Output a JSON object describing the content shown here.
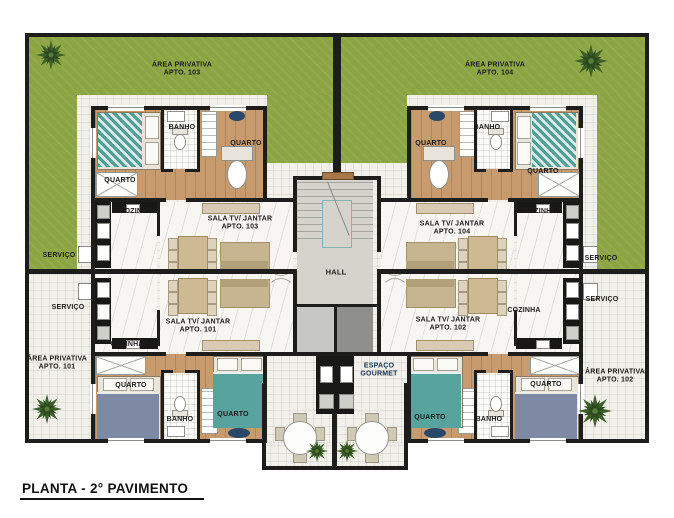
{
  "title": "PLANTA - 2° PAVIMENTO",
  "core": {
    "hall": "HALL",
    "gourmet_line1": "ESPAÇO",
    "gourmet_line2": "GOURMET"
  },
  "rooms": {
    "quarto": "QUARTO",
    "banho": "BANHO",
    "cozinha": "COZINHA",
    "servico": "SERVIÇO",
    "sala": "SALA TV/ JANTAR",
    "area": "ÁREA PRIVATIVA"
  },
  "apartments": {
    "a101": {
      "apto": "APTO. 101"
    },
    "a102": {
      "apto": "APTO. 102"
    },
    "a103": {
      "apto": "APTO. 103"
    },
    "a104": {
      "apto": "APTO. 104"
    }
  },
  "colors": {
    "lawn": "#8CA543",
    "wall": "#1D1D1B",
    "wood_floor": "#C89B6E",
    "teal_bed": "#57A39D",
    "hall_floor": "#D5D3CC",
    "gourmet_text": "#16324F"
  }
}
